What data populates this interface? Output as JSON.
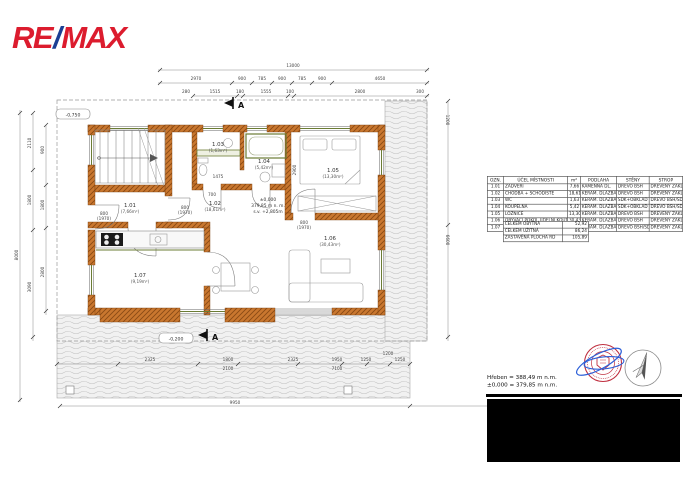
{
  "logo": {
    "re": "RE",
    "slash": "/",
    "max": "MAX"
  },
  "plan": {
    "section_marker": "A",
    "levels": {
      "entry": "-0,750",
      "terrace": "-0,200"
    },
    "elevation": {
      "l1": "±0,000",
      "l2": "379,85 m n. m.",
      "l3": "s.v. +2,805m"
    },
    "rooms": [
      {
        "no": "1.01",
        "area": "(7,66m²)",
        "x": 130,
        "y": 207
      },
      {
        "no": "1.02",
        "area": "(18,61m²)",
        "x": 215,
        "y": 205
      },
      {
        "no": "1.03",
        "area": "(1,63m²)",
        "x": 218,
        "y": 146
      },
      {
        "no": "1.04",
        "area": "(5,42m²)",
        "x": 264,
        "y": 163
      },
      {
        "no": "1.05",
        "area": "(13,30m²)",
        "x": 333,
        "y": 172
      },
      {
        "no": "1.06",
        "area": "(30,43m²)",
        "x": 330,
        "y": 240
      },
      {
        "no": "1.07",
        "area": "(9,19m²)",
        "x": 140,
        "y": 277
      }
    ],
    "dim_labels": [
      {
        "t": "13000",
        "x": 293,
        "y": 67
      },
      {
        "t": "2970",
        "x": 196,
        "y": 80
      },
      {
        "t": "900",
        "x": 242,
        "y": 80
      },
      {
        "t": "785",
        "x": 262,
        "y": 80
      },
      {
        "t": "900",
        "x": 282,
        "y": 80
      },
      {
        "t": "785",
        "x": 302,
        "y": 80
      },
      {
        "t": "900",
        "x": 322,
        "y": 80
      },
      {
        "t": "4650",
        "x": 380,
        "y": 80
      },
      {
        "t": "280",
        "x": 186,
        "y": 93
      },
      {
        "t": "1515",
        "x": 215,
        "y": 93
      },
      {
        "t": "180",
        "x": 240,
        "y": 93
      },
      {
        "t": "1555",
        "x": 266,
        "y": 93
      },
      {
        "t": "100",
        "x": 290,
        "y": 93
      },
      {
        "t": "2800",
        "x": 360,
        "y": 93
      },
      {
        "t": "300",
        "x": 420,
        "y": 93
      },
      {
        "t": "8000",
        "x": 18,
        "y": 255,
        "r": -90
      },
      {
        "t": "2110",
        "x": 31,
        "y": 143,
        "r": -90
      },
      {
        "t": "1800",
        "x": 31,
        "y": 200,
        "r": -90
      },
      {
        "t": "3090",
        "x": 31,
        "y": 287,
        "r": -90
      },
      {
        "t": "900",
        "x": 44,
        "y": 150,
        "r": -90
      },
      {
        "t": "1800",
        "x": 44,
        "y": 205,
        "r": -90
      },
      {
        "t": "2800",
        "x": 44,
        "y": 272,
        "r": -90
      },
      {
        "t": "1200",
        "x": 446,
        "y": 120,
        "r": 90
      },
      {
        "t": "6600",
        "x": 446,
        "y": 240,
        "r": 90
      },
      {
        "t": "2325",
        "x": 150,
        "y": 361
      },
      {
        "t": "1800",
        "x": 228,
        "y": 361
      },
      {
        "t": "2100",
        "x": 228,
        "y": 370
      },
      {
        "t": "2325",
        "x": 293,
        "y": 361
      },
      {
        "t": "1950",
        "x": 337,
        "y": 361
      },
      {
        "t": "7100",
        "x": 337,
        "y": 370
      },
      {
        "t": "1250",
        "x": 366,
        "y": 361
      },
      {
        "t": "1200",
        "x": 388,
        "y": 355
      },
      {
        "t": "1250",
        "x": 400,
        "y": 361
      },
      {
        "t": "9950",
        "x": 235,
        "y": 404
      },
      {
        "t": "5550",
        "x": 505,
        "y": 404
      },
      {
        "t": "800",
        "x": 104,
        "y": 215
      },
      {
        "t": "(1970)",
        "x": 104,
        "y": 220
      },
      {
        "t": "800",
        "x": 185,
        "y": 209
      },
      {
        "t": "(1970)",
        "x": 185,
        "y": 214
      },
      {
        "t": "800",
        "x": 304,
        "y": 224
      },
      {
        "t": "(1970)",
        "x": 304,
        "y": 229
      },
      {
        "t": "700",
        "x": 212,
        "y": 196
      },
      {
        "t": "1475",
        "x": 218,
        "y": 178
      },
      {
        "t": "2900",
        "x": 296,
        "y": 170,
        "r": -90
      }
    ]
  },
  "room_table": {
    "headers": [
      "OZN.",
      "ÚČEL MÍSTNOSTI",
      "m²",
      "PODLAHA",
      "STĚNY",
      "STROP"
    ],
    "rows": [
      [
        "1.01",
        "ZÁDVEŘÍ",
        "7,66",
        "KAMENNÁ DL.",
        "DŘEVO BSH",
        "DŘEVĚNÝ ZÁKLOP"
      ],
      [
        "1.02",
        "CHODBA + SCHODIŠTĚ",
        "18,61",
        "KERAM. DLAŽBA",
        "DŘEVO BSH",
        "DŘEVĚNÝ ZÁKLOP"
      ],
      [
        "1.03",
        "WC",
        "1,63",
        "KERAM. DLAŽBA",
        "SDK+OBKLAD",
        "DŘEVO BSH/SDK"
      ],
      [
        "1.04",
        "KOUPELNA",
        "5,42",
        "KERAM. DLAŽBA",
        "SDK+OBKLAD",
        "DŘEVO BSH/SDK"
      ],
      [
        "1.05",
        "LOŽNICE",
        "13,30",
        "KERAM. DLAŽBA",
        "DŘEVO BSH",
        "DŘEVĚNÝ ZÁKLOP"
      ],
      [
        "1.06",
        "OBÝVACÍ POKOJ, JÍDELNÍ KOUT",
        "30,43",
        "KERAM. DLAŽBA",
        "DŘEVO BSH",
        "DŘEVĚNÝ ZÁKLOP"
      ],
      [
        "1.07",
        "KUCHYNĚ",
        "9,19",
        "KERAM. DLAŽBA",
        "DŘEVO BSH/SDK",
        "DŘEVĚNÝ ZÁKLOP"
      ]
    ],
    "summary": [
      [
        "CELKEM OBYTNÁ",
        "52,92"
      ],
      [
        "CELKEM UŽITNÁ",
        "86,24"
      ],
      [
        "ZASTAVĚNÁ PLOCHA RD",
        "105,89"
      ]
    ]
  },
  "notes": {
    "ridge": "Hřeben = 388,49 m n.m.",
    "zero": "±0,000 = 379,85 m n.m."
  },
  "colors": {
    "wall": "#c9772f",
    "wall_hatch": "#8a4a14",
    "installation_green": "#6b7c34",
    "remax_red": "#dc1c2e",
    "remax_blue": "#1b3f94",
    "stamp_red": "#c03040",
    "signature_blue": "#2c5fd8"
  }
}
